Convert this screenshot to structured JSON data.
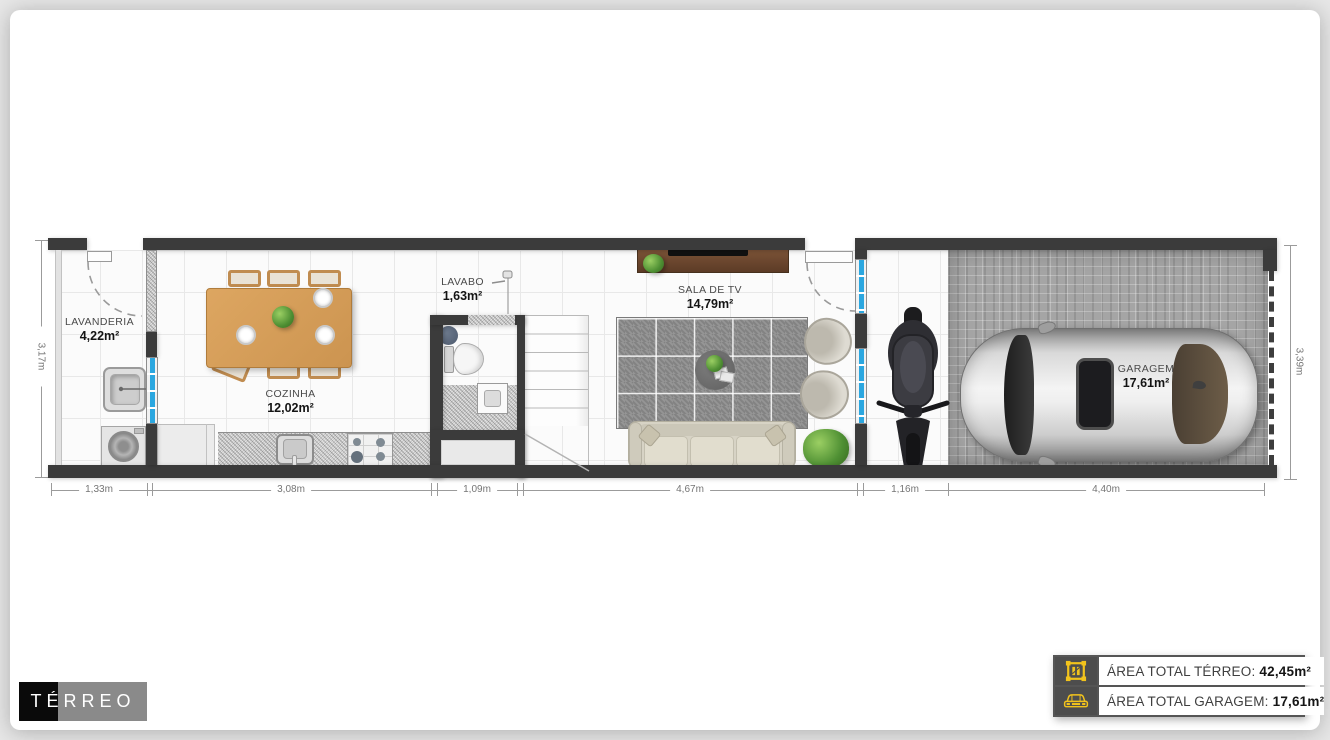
{
  "title_block": {
    "title": "TÉRREO"
  },
  "rooms": {
    "lavanderia": {
      "name": "LAVANDERIA",
      "area": "4,22m²"
    },
    "cozinha": {
      "name": "COZINHA",
      "area": "12,02m²"
    },
    "lavabo": {
      "name": "LAVABO",
      "area": "1,63m²"
    },
    "sala": {
      "name": "SALA DE TV",
      "area": "14,79m²"
    },
    "garagem": {
      "name": "GARAGEM",
      "area": "17,61m²"
    }
  },
  "dimensions": {
    "bottom": {
      "d1": "1,33m",
      "d2": "3,08m",
      "d3": "1,09m",
      "d4": "4,67m",
      "d5": "1,16m",
      "d6": "4,40m"
    },
    "left": "3,17m",
    "right": "3,39m"
  },
  "legend": {
    "rows": [
      {
        "icon": "floorplan-icon",
        "label": "ÁREA TOTAL TÉRREO:",
        "value": "42,45m²"
      },
      {
        "icon": "car-icon",
        "label": "ÁREA TOTAL GARAGEM:",
        "value": "17,61m²"
      }
    ]
  },
  "colors": {
    "wall": "#3b3b3b",
    "window_glass": "#2ba7e0",
    "accent_yellow": "#f2c31c"
  }
}
